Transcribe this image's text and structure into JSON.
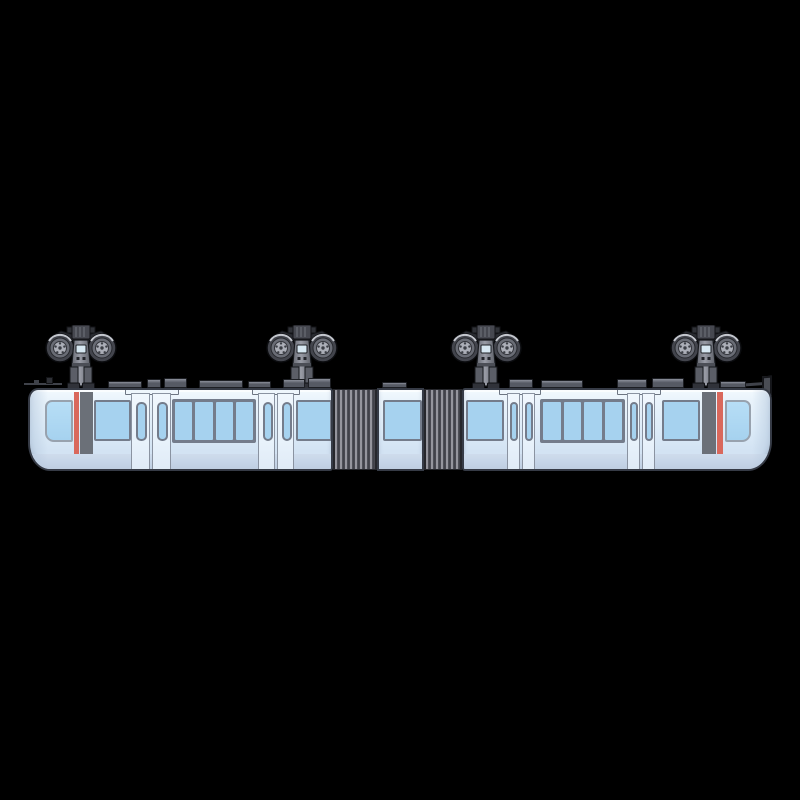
{
  "scene": {
    "description": "Side-view illustration of a light-blue two-car suspended monorail train hanging from four twin-wheel bogies, joined by two accordion gangways around a short middle module, on a solid black background",
    "train_type": "suspended monorail",
    "car_count": 2,
    "middle_module_count": 1,
    "gangway_count": 2,
    "bogie_count": 4,
    "wheels_per_bogie": 2,
    "door_pairs_per_car": 2,
    "window_panes_in_center_band": 4,
    "cab_accent": "vertical red stripe beside dark pillar at each cab end"
  },
  "colors": {
    "background": "#000000",
    "body-roof": "#f2f9fe",
    "body-light": "#e9f3fb",
    "body-lower": "#c6d5e8",
    "body-outline": "#363b46",
    "window-blue": "#a6d2ef",
    "window-frame": "#747c8b",
    "door-fill": "#e8f2fb",
    "door-outline": "#8a93a1",
    "accent-red": "#d9685c",
    "pillar-gray": "#6b7078",
    "bellows-light": "#95959d",
    "bellows-dark": "#3a3b42",
    "bellows-edge": "#26272c",
    "roofbox-light": "#8b8f9a",
    "roofbox-dark": "#565a64",
    "roofbox-outline": "#1d1f24",
    "metal-dark": "#3f424a"
  }
}
